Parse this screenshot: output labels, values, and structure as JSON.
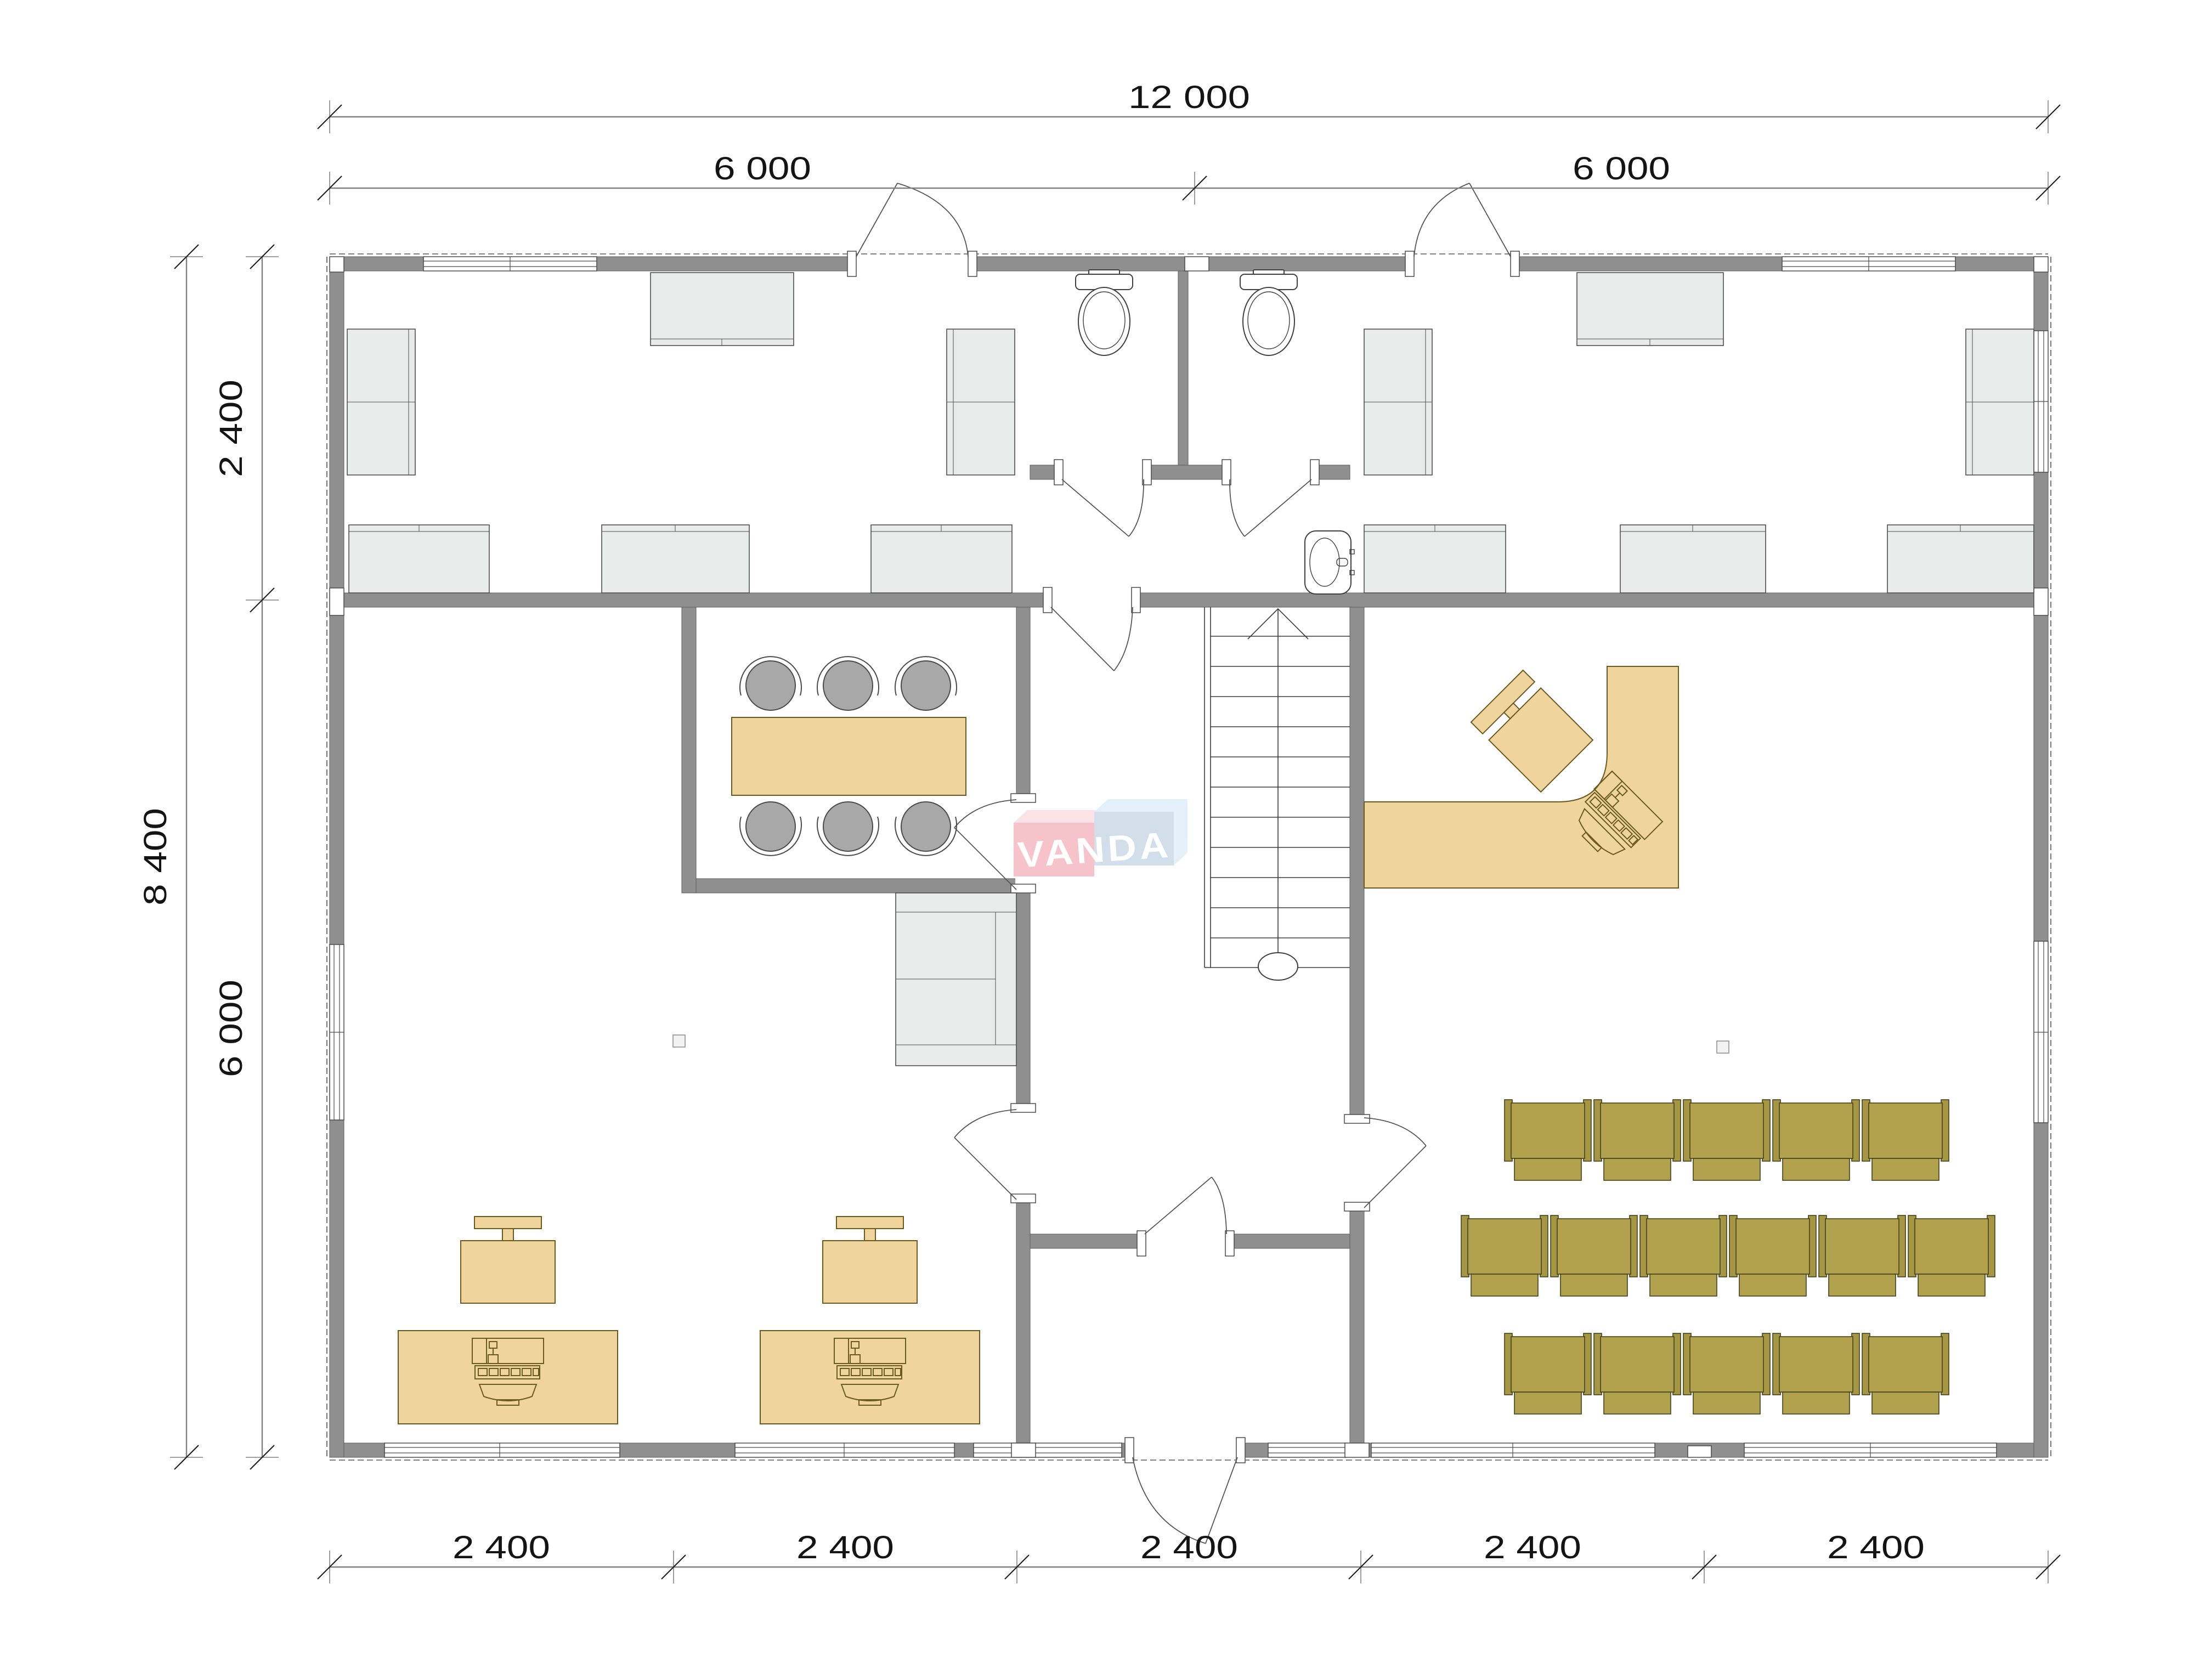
{
  "dimensions": {
    "top_total": "12 000",
    "top_left": "6 000",
    "top_right": "6 000",
    "left_total": "8 400",
    "left_upper": "2 400",
    "left_lower": "6 000",
    "bottom": [
      "2 400",
      "2 400",
      "2 400",
      "2 400",
      "2 400"
    ]
  },
  "watermark": {
    "text": "VANDA"
  },
  "colors": {
    "wall": "#8f8f8f",
    "furniture_light": "#e9eaea",
    "furniture_tan": "#efd49c",
    "chair_olive": "#b1a14d",
    "chair_olive_dark": "#a59644",
    "watermark_pink": "#f4b9c0",
    "watermark_pink_light": "#fadde2",
    "watermark_blue": "#ccd9e8",
    "watermark_blue_light": "#dfeefa",
    "dim_line": "#808080",
    "text": "#141414"
  }
}
